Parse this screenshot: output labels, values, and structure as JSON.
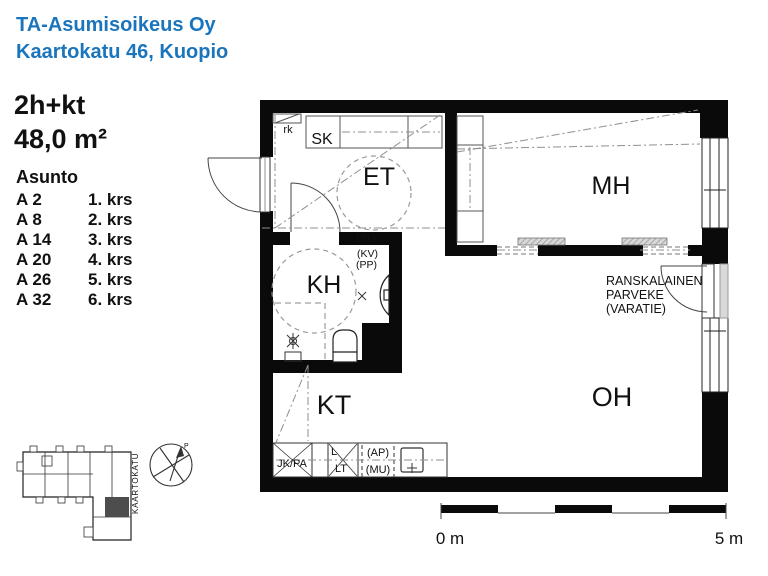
{
  "header": {
    "line1": "TA-Asumisoikeus Oy",
    "line2": "Kaartokatu 46, Kuopio"
  },
  "info": {
    "type": "2h+kt",
    "area": "48,0 m²",
    "list_title": "Asunto",
    "units": [
      {
        "id": "A 2",
        "floor": "1. krs"
      },
      {
        "id": "A 8",
        "floor": "2. krs"
      },
      {
        "id": "A 14",
        "floor": "3. krs"
      },
      {
        "id": "A 20",
        "floor": "4. krs"
      },
      {
        "id": "A 26",
        "floor": "5. krs"
      },
      {
        "id": "A 32",
        "floor": "6. krs"
      }
    ]
  },
  "plan": {
    "rooms": {
      "et": "ET",
      "mh": "MH",
      "kh": "KH",
      "kt": "KT",
      "oh": "OH"
    },
    "fixtures": {
      "rk": "rk",
      "sk": "SK",
      "lto": "LTO",
      "kv": "(KV)",
      "pp": "(PP)",
      "jk_pa": "JK/PA",
      "l": "L",
      "lt": "LT",
      "ap": "(AP)",
      "mu": "(MU)"
    },
    "balcony": {
      "line1": "RANSKALAINEN",
      "line2": "PARVEKE",
      "line3": "(VARATIE)"
    }
  },
  "site": {
    "street": "KAARTOKATU",
    "north": "P"
  },
  "scale": {
    "start": "0 m",
    "end": "5 m"
  },
  "colors": {
    "accent": "#1b75bc",
    "wall": "#0a0a0a"
  }
}
